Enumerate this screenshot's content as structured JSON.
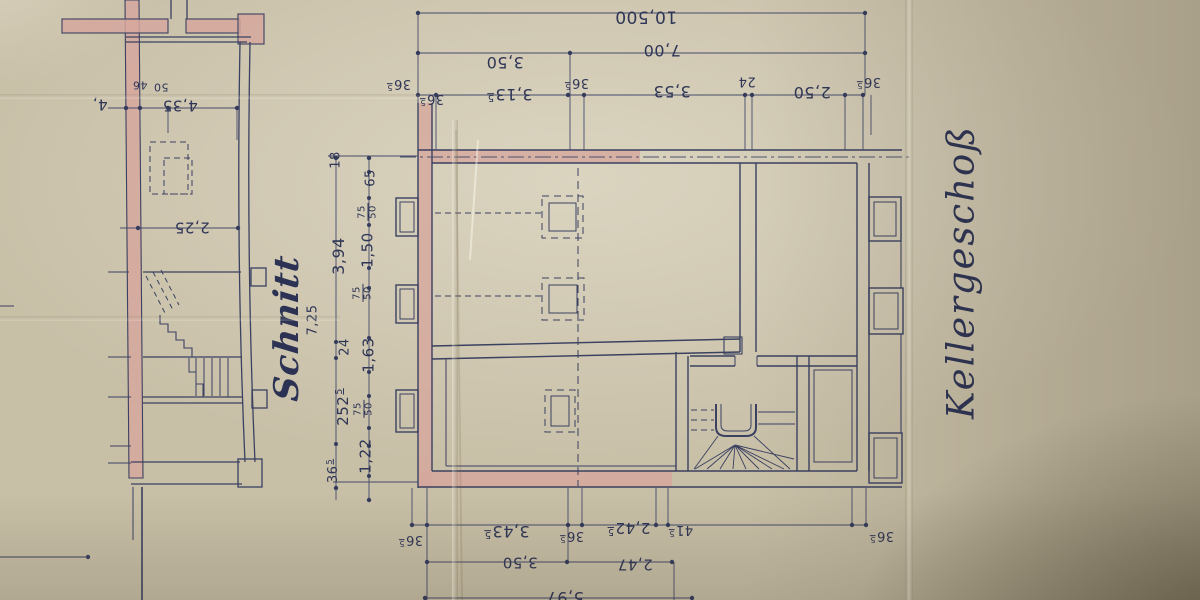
{
  "titles": {
    "section": "Schnitt",
    "plan": "Kellergeschoß"
  },
  "colors": {
    "paper": "#c8bfa7",
    "ink": "#3a4161",
    "ink_thin": "#4a5070",
    "text_ink": "#2e3556",
    "wall_fill_pink": "#d6a79d"
  },
  "labels": [
    {
      "name": "dim-top-total",
      "text": "10,500",
      "x": 646,
      "y": 16,
      "rot": 180,
      "size": 17
    },
    {
      "name": "dim-top-7-00",
      "text": "7,00",
      "x": 662,
      "y": 50,
      "rot": 180,
      "size": 16
    },
    {
      "name": "dim-top-3-50",
      "text": "3,50",
      "x": 505,
      "y": 62,
      "rot": 180,
      "size": 16
    },
    {
      "name": "dim-top-36-5-a",
      "text": "36",
      "sup": "5",
      "x": 399,
      "y": 84,
      "rot": 180,
      "size": 13
    },
    {
      "name": "dim-top-36-5-b",
      "text": "36",
      "sup": "5",
      "x": 432,
      "y": 99,
      "rot": 180,
      "size": 13
    },
    {
      "name": "dim-top-3-13-5",
      "text": "3,13",
      "sup": "5",
      "x": 510,
      "y": 94,
      "rot": 180,
      "size": 16
    },
    {
      "name": "dim-top-36-5-c",
      "text": "36",
      "sup": "5",
      "x": 577,
      "y": 83,
      "rot": 180,
      "size": 13
    },
    {
      "name": "dim-top-3-53",
      "text": "3,53",
      "x": 672,
      "y": 91,
      "rot": 180,
      "size": 16
    },
    {
      "name": "dim-top-24",
      "text": "24",
      "x": 747,
      "y": 81,
      "rot": 180,
      "size": 13
    },
    {
      "name": "dim-top-2-50",
      "text": "2,50",
      "x": 812,
      "y": 92,
      "rot": 180,
      "size": 16
    },
    {
      "name": "dim-top-36-5-d",
      "text": "36",
      "sup": "5",
      "x": 869,
      "y": 82,
      "rot": 180,
      "size": 13
    },
    {
      "name": "dim-sec-4-35",
      "text": "4,35",
      "x": 180,
      "y": 105,
      "rot": 180,
      "size": 15
    },
    {
      "name": "dim-sec-50",
      "text": "50",
      "x": 161,
      "y": 87,
      "rot": 180,
      "size": 11
    },
    {
      "name": "dim-sec-46",
      "text": "46",
      "x": 140,
      "y": 85,
      "rot": 180,
      "size": 11
    },
    {
      "name": "dim-sec-partial-4",
      "text": "4,",
      "x": 100,
      "y": 104,
      "rot": 180,
      "size": 15
    },
    {
      "name": "dim-sec-2-25",
      "text": "2,25",
      "x": 192,
      "y": 227,
      "rot": 180,
      "size": 15
    },
    {
      "name": "dim-left-18",
      "text": "18",
      "x": 336,
      "y": 160,
      "rot": -90,
      "size": 13
    },
    {
      "name": "dim-left-65",
      "text": "65",
      "x": 371,
      "y": 178,
      "rot": -90,
      "size": 13
    },
    {
      "name": "dim-left-75-50-a",
      "frac": [
        "75",
        "50"
      ],
      "x": 368,
      "y": 212,
      "rot": -90,
      "size": 10
    },
    {
      "name": "dim-left-1-50",
      "text": "1,50",
      "x": 368,
      "y": 250,
      "rot": -90,
      "size": 15
    },
    {
      "name": "dim-left-3-94",
      "text": "3,94",
      "x": 339,
      "y": 256,
      "rot": -90,
      "size": 16
    },
    {
      "name": "dim-left-75-50-b",
      "frac": [
        "75",
        "50"
      ],
      "x": 363,
      "y": 293,
      "rot": -90,
      "size": 10
    },
    {
      "name": "dim-left-7-25",
      "text": "7,25",
      "x": 313,
      "y": 320,
      "rot": -90,
      "size": 13
    },
    {
      "name": "dim-left-24",
      "text": "24",
      "x": 345,
      "y": 347,
      "rot": -90,
      "size": 13
    },
    {
      "name": "dim-left-1-63",
      "text": "1,63",
      "x": 369,
      "y": 355,
      "rot": -90,
      "size": 15
    },
    {
      "name": "dim-left-252-5",
      "text": "252",
      "sup": "5",
      "x": 343,
      "y": 407,
      "rot": -90,
      "size": 15
    },
    {
      "name": "dim-left-75-50-c",
      "frac": [
        "75",
        "50"
      ],
      "x": 364,
      "y": 409,
      "rot": -90,
      "size": 10
    },
    {
      "name": "dim-left-1-22",
      "text": "1,22",
      "x": 366,
      "y": 456,
      "rot": -90,
      "size": 15
    },
    {
      "name": "dim-left-36-5",
      "text": "36",
      "sup": "5",
      "x": 333,
      "y": 471,
      "rot": -90,
      "size": 13
    },
    {
      "name": "dim-bot-36-5-a",
      "text": "36",
      "sup": "5",
      "x": 411,
      "y": 540,
      "rot": 180,
      "size": 13
    },
    {
      "name": "dim-bot-3-43-5",
      "text": "3,43",
      "sup": "5",
      "x": 507,
      "y": 531,
      "rot": 180,
      "size": 16
    },
    {
      "name": "dim-bot-36-5-b",
      "text": "36",
      "sup": "5",
      "x": 572,
      "y": 536,
      "rot": 180,
      "size": 13
    },
    {
      "name": "dim-bot-2-42-5",
      "text": "2,42",
      "sup": "5",
      "x": 629,
      "y": 528,
      "rot": 180,
      "size": 15
    },
    {
      "name": "dim-bot-41-5",
      "text": "41",
      "sup": "5",
      "x": 681,
      "y": 530,
      "rot": 180,
      "size": 13
    },
    {
      "name": "dim-bot-36-5-c",
      "text": "36",
      "sup": "5",
      "x": 882,
      "y": 536,
      "rot": 180,
      "size": 13
    },
    {
      "name": "dim-bot-3-50",
      "text": "3,50",
      "x": 520,
      "y": 562,
      "rot": 180,
      "size": 15
    },
    {
      "name": "dim-bot-2-47",
      "text": "2,47",
      "x": 635,
      "y": 564,
      "rot": 180,
      "size": 15
    },
    {
      "name": "dim-bot-5-97",
      "text": "5,97",
      "x": 565,
      "y": 597,
      "rot": 180,
      "size": 16
    }
  ]
}
